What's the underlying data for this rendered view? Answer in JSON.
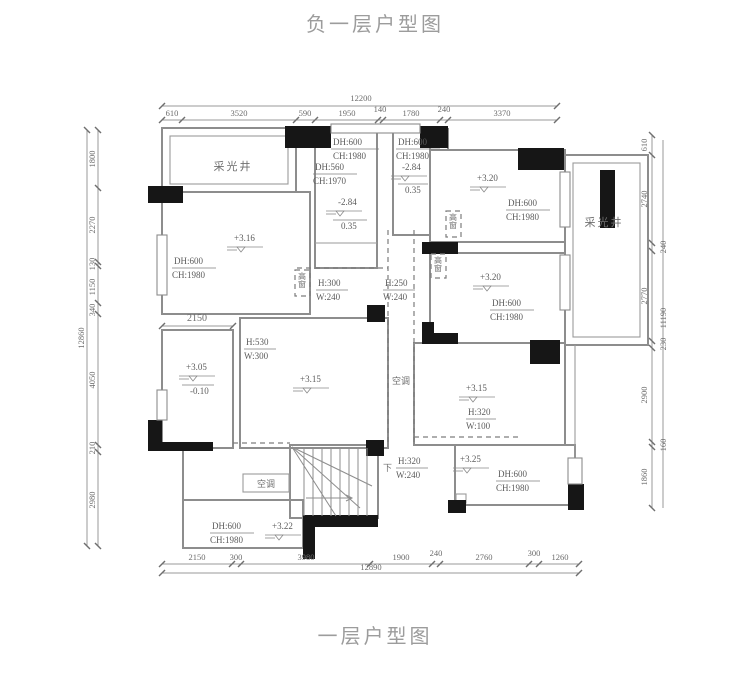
{
  "title_top": "负一层户型图",
  "title_bottom": "一层户型图",
  "dims": {
    "top": {
      "total": "12200",
      "segs": [
        "610",
        "3520",
        "590",
        "1950",
        "140",
        "1780",
        "240",
        "3370"
      ]
    },
    "bottom": {
      "total": "12890",
      "segs": [
        "2150",
        "300",
        "3980",
        "1900",
        "240",
        "2760",
        "300",
        "1260"
      ]
    },
    "left": {
      "total": "12860",
      "segs": [
        "1800",
        "2270",
        "130",
        "1150",
        "340",
        "4050",
        "210",
        "2980"
      ]
    },
    "right": {
      "total": "11190",
      "segs": [
        "610",
        "2740",
        "240",
        "2770",
        "230",
        "2900",
        "160",
        "1860"
      ]
    },
    "inner": {
      "room_split": "2150"
    }
  },
  "rooms": {
    "light_well_left": "采光井",
    "light_well_right": "采光井",
    "ac_shaft": "空调",
    "ac_platform": "空调",
    "stairs_down": "下",
    "high_window": "高窗"
  },
  "annotations": {
    "a_top": {
      "dh": "DH:600",
      "ch": "CH:1980"
    },
    "a_mid": {
      "dh": "DH:560",
      "ch": "CH:1970"
    },
    "a_level": {
      "upper": "-2.84",
      "lower": "0.35"
    },
    "b": {
      "dh": "DH:600",
      "ch": "CH:1980",
      "upper": "-2.84",
      "lower": "0.35"
    },
    "c": {
      "level": "+3.20",
      "dh": "DH:600",
      "ch": "CH:1980"
    },
    "d": {
      "level": "+3.20",
      "dh": "DH:600",
      "ch": "CH:1980"
    },
    "e": {
      "level": "+3.16",
      "dh": "DH:600",
      "ch": "CH:1980"
    },
    "f": {
      "upper": "+3.05",
      "lower": "-0.10"
    },
    "g": {
      "level": "+3.15"
    },
    "h": {
      "level": "+3.15",
      "h": "H:320",
      "w": "W:100"
    },
    "i": {
      "level": "+3.25",
      "dh": "DH:600",
      "ch": "CH:1980"
    },
    "bl": {
      "dh": "DH:600",
      "ch": "CH:1980",
      "level": "+3.22"
    },
    "win1": {
      "h": "H:300",
      "w": "W:240"
    },
    "win2": {
      "h": "H:250",
      "w": "W:240"
    },
    "win3": {
      "h": "H:530",
      "w": "W:300"
    },
    "win4": {
      "h": "H:320",
      "w": "W:240"
    }
  }
}
